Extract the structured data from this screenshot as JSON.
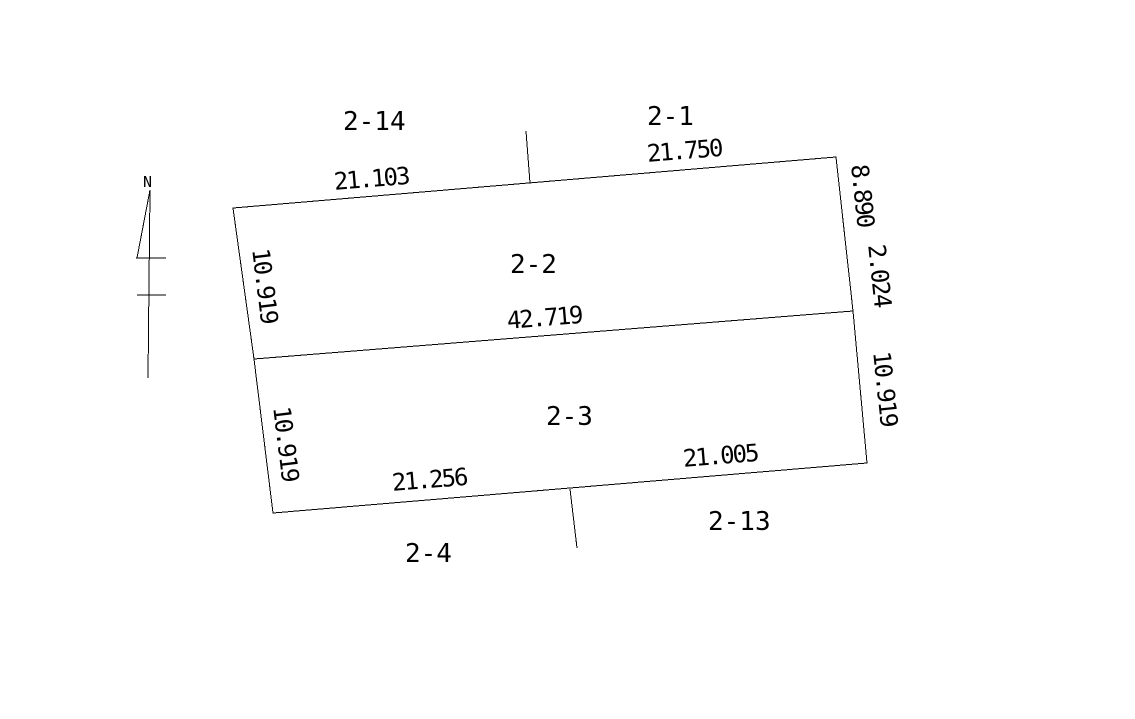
{
  "canvas": {
    "bg_color": "#ffffff",
    "line_color": "#000000"
  },
  "north_arrow": {
    "label": "N"
  },
  "parcels": {
    "upper": {
      "label": "2-2"
    },
    "lower": {
      "label": "2-3"
    }
  },
  "neighbors": {
    "top_left": {
      "label": "2-14"
    },
    "top_right": {
      "label": "2-1"
    },
    "bottom_left": {
      "label": "2-4"
    },
    "bottom_right": {
      "label": "2-13"
    }
  },
  "dimensions": {
    "top_left_segment": "21.103",
    "top_right_segment": "21.750",
    "divider": "42.719",
    "bottom_left_segment": "21.256",
    "bottom_right_segment": "21.005",
    "left_upper": "10.919",
    "left_lower": "10.919",
    "right_upper": "8.890",
    "right_upper_sub": "2.024",
    "right_lower": "10.919"
  }
}
